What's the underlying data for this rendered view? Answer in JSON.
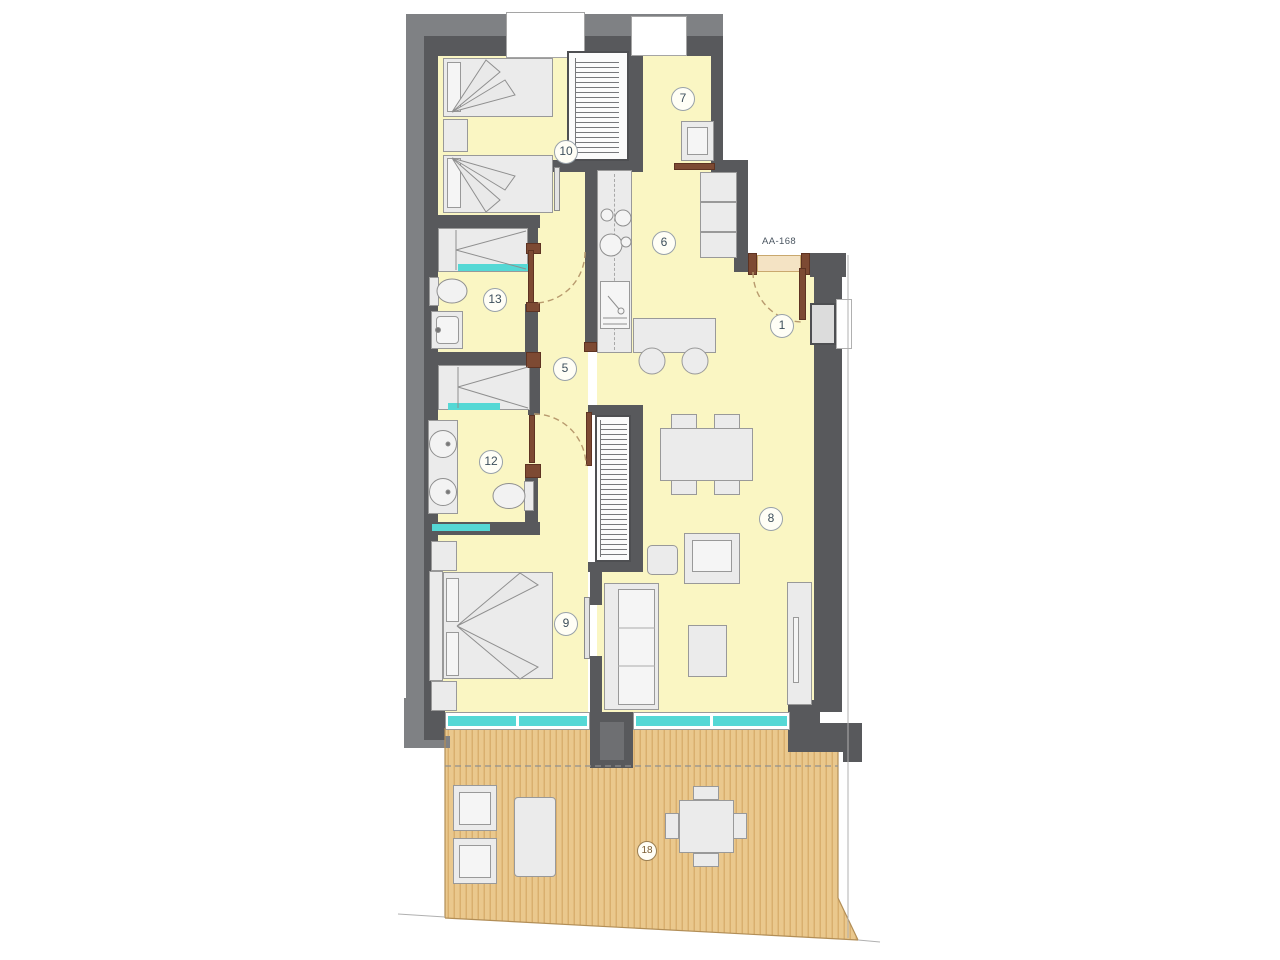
{
  "plan": {
    "door_label": "AA-168",
    "rooms": [
      {
        "id": "bedroom-twin",
        "number": "10"
      },
      {
        "id": "utility-room",
        "number": "7"
      },
      {
        "id": "kitchen",
        "number": "6"
      },
      {
        "id": "bathroom-top",
        "number": "13"
      },
      {
        "id": "hallway",
        "number": "5"
      },
      {
        "id": "entrance-hall",
        "number": "1"
      },
      {
        "id": "bathroom-bottom",
        "number": "12"
      },
      {
        "id": "living-dining-room",
        "number": "8"
      },
      {
        "id": "master-bedroom",
        "number": "9"
      },
      {
        "id": "terrace",
        "number": "18"
      }
    ],
    "colors": {
      "wall": "#58595c",
      "wall_outer": "#7f8184",
      "floor": "#faf6c3",
      "deck": "#eac88d",
      "deck_stripe": "#d9af6e",
      "glass": "#55d8d5",
      "door_frame": "#7d4a33",
      "door_opening": "#f4e3c4",
      "furniture_fill": "#ebebeb",
      "furniture_border": "#999999",
      "label_text": "#3d4f5c",
      "terrace_label": "#7a5c33"
    }
  }
}
